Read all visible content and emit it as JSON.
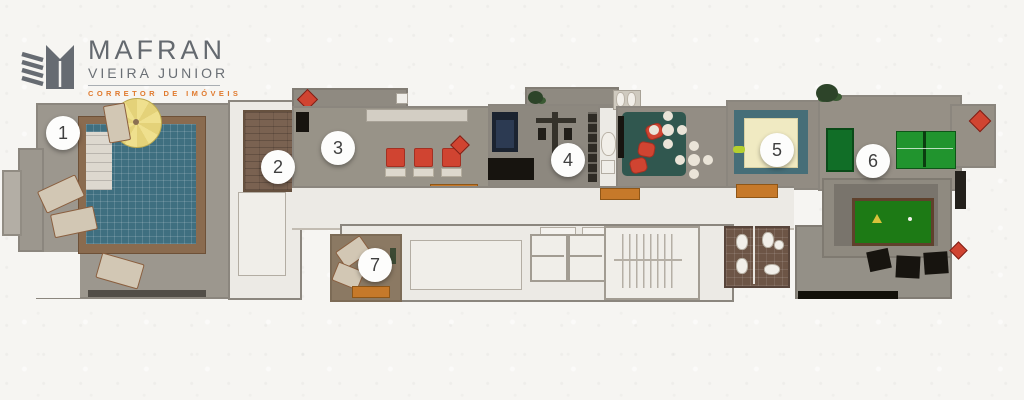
{
  "logo": {
    "brand": "MAFRAN",
    "subtitle": "VIEIRA JUNIOR",
    "tagline": "CORRETOR DE IMÓVEIS"
  },
  "plan": {
    "markers": [
      {
        "label": "1",
        "x": 63,
        "y": 133
      },
      {
        "label": "2",
        "x": 278,
        "y": 167
      },
      {
        "label": "3",
        "x": 338,
        "y": 148
      },
      {
        "label": "4",
        "x": 568,
        "y": 160
      },
      {
        "label": "5",
        "x": 777,
        "y": 150
      },
      {
        "label": "6",
        "x": 873,
        "y": 161
      },
      {
        "label": "7",
        "x": 375,
        "y": 265
      }
    ],
    "colors": {
      "terrace": "#9c978e",
      "floor_light": "#eceae5",
      "wall": "#8b867e",
      "pool": "#3f6f80",
      "deck_wood": "#7a6251",
      "accent_orange": "#e07a2e",
      "furniture_red": "#d04431",
      "bench_orange": "#c6792a",
      "pingpong_green": "#21942e",
      "billiard_green": "#1d7a15",
      "mat_teal": "#30574f",
      "kids_mat_cream": "#f0eac2",
      "bathroom_tile": "#6d5546"
    }
  }
}
